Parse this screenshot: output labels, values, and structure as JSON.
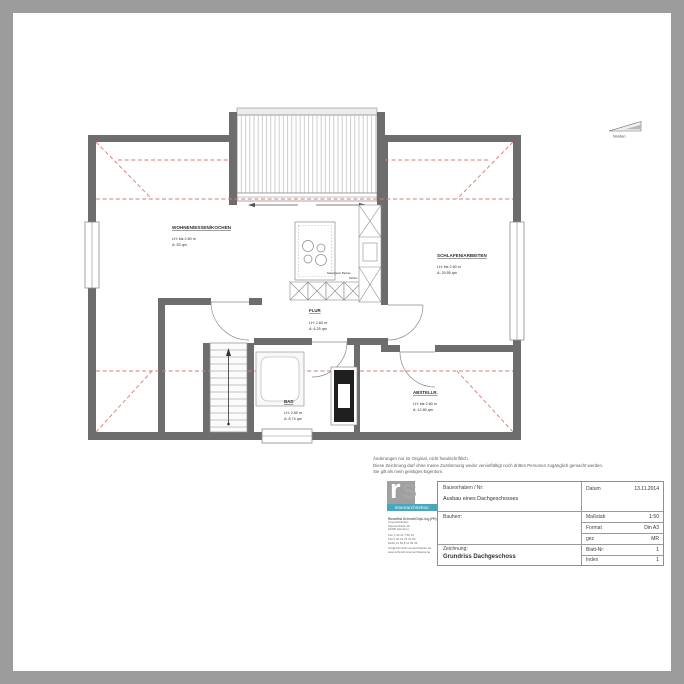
{
  "north": {
    "label": "Norden"
  },
  "rooms": {
    "wohnen": {
      "name": "WOHNEN/ESSEN/KOCHEN",
      "height": "LH: bis 2.60 m",
      "area": "A: 53 qm"
    },
    "schlafen": {
      "name": "SCHLAFEN/ARBEITEN",
      "height": "LH: bis 2.60 m",
      "area": "A: 29.55 qm"
    },
    "flur": {
      "name": "FLUR",
      "height": "LH: 2.60 m",
      "area": "A: 6.25 qm"
    },
    "bad": {
      "name": "BAD",
      "height": "LH: 2.60 m",
      "area": "A: 8.74 qm"
    },
    "abstell": {
      "name": "ABSTELLR.",
      "height": "LH: bis 2.60 m",
      "area": "A: 12.80 qm"
    }
  },
  "kitchen": {
    "appliances_label": "Dampfgarer Backen",
    "cooling_label": "Kühlen"
  },
  "disclaimer": {
    "line1": "Änderungen nur im Original, nicht handschriftlich.",
    "line2": "Diese Zeichnung darf ohne meine Zustimmung weder vervielfältigt noch dritten Personen zugänglich gemacht werden.",
    "line3": "Sie gilt als mein geistiges Eigentum."
  },
  "titleblock": {
    "logo_text_r": "r",
    "logo_text_s": "s",
    "logo_subtitle": "innenarchitektur",
    "firm_name": "Roswitha Schmidt Dipl.-Ing.(FH)",
    "firm_lines": [
      "Innenarchitektin",
      "Spenerstraße 49",
      "22305 Hamburg",
      "Fon 0 40 41 7 66 10",
      "Fax 0 40 41 74 31 50",
      "Mobil 01 59 8 11 06 43",
      "info@schmidt-innenarchitektur.de",
      "www.schmidt-innenarchitektur.de"
    ],
    "project_label": "Bauvorhaben / Nr:",
    "project_value": "Ausbau eines Dachgeschosses",
    "client_label": "Bauherr:",
    "drawing_label": "Zeichnung:",
    "drawing_value": "Grundriss Dachgeschoss",
    "date_label": "Datum",
    "date_value": "13.11.2014",
    "scale_label": "Maßstab",
    "scale_value": "1:50",
    "format_label": "Format",
    "format_value": "Din A3",
    "drawn_label": "gez",
    "drawn_value": "MR",
    "sheet_label": "Blatt-Nr:",
    "sheet_value": "1",
    "index_label": "Index",
    "index_value": "1"
  },
  "colors": {
    "wall": "#6d6d6d",
    "roof_line": "#d97777",
    "logo_accent": "#49a7bd"
  }
}
